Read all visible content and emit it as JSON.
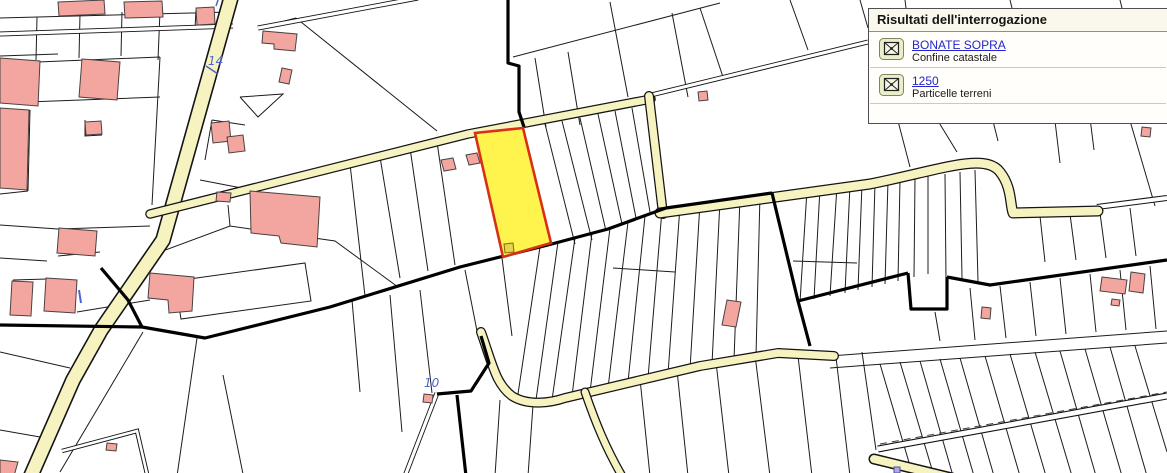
{
  "panel": {
    "title": "Risultati dell'interrogazione",
    "results": [
      {
        "icon": "locate-result-icon",
        "label": "BONATE SOPRA",
        "sublabel": "Confine catastale"
      },
      {
        "icon": "locate-result-icon",
        "label": "1250",
        "sublabel": "Particelle terreni"
      }
    ]
  },
  "map": {
    "labels": [
      {
        "text": "14"
      },
      {
        "text": "10"
      }
    ]
  },
  "colors": {
    "road_fill": "#f7f3c0",
    "building_fill": "#f3a6a0",
    "building_stroke": "#4a4141",
    "highlight_fill": "#fff44d",
    "highlight_stroke": "#d92f17",
    "map_label_color": "#4d63cf",
    "link_color": "#2425cd",
    "panel_bg": "#fffefa",
    "panel_header_bg": "#faf8ed"
  }
}
